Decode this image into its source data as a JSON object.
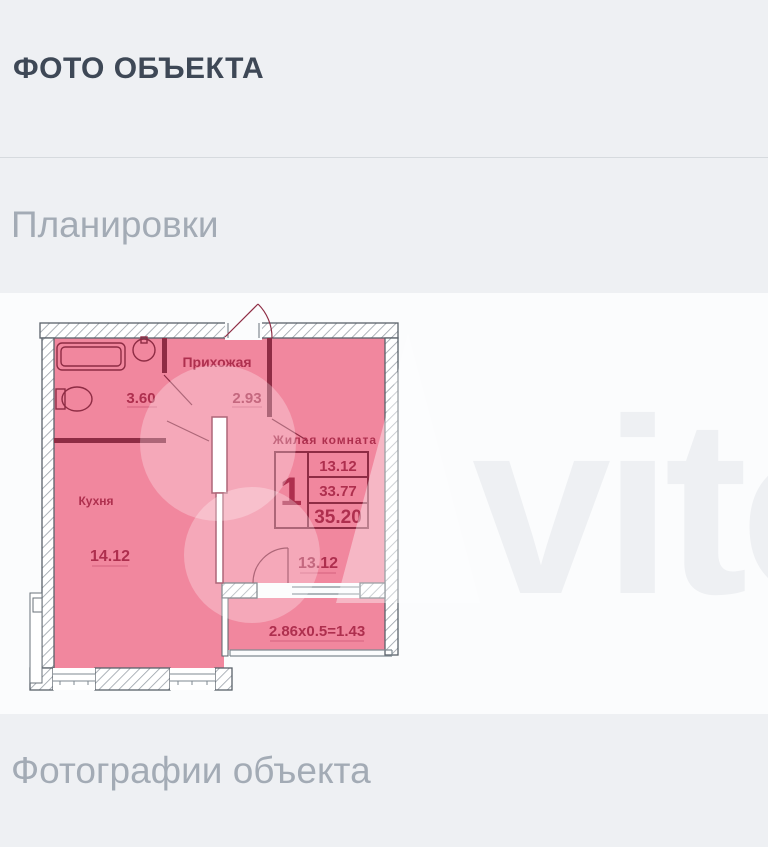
{
  "page": {
    "title": "ФОТО ОБЪЕКТА",
    "sections": {
      "floorplans": "Планировки",
      "photos": "Фотографии объекта"
    }
  },
  "floorplan": {
    "rooms": {
      "hallway": {
        "name": "Прихожая",
        "area": "2.93"
      },
      "bathroom": {
        "area": "3.60"
      },
      "kitchen": {
        "name": "Кухня",
        "area": "14.12"
      },
      "living": {
        "name": "Жилая комната",
        "area": "13.12"
      }
    },
    "balcony": {
      "formula": "2.86x0.5=1.43"
    },
    "stamp": {
      "rooms_count": "1",
      "living_area": "13.12",
      "area_wo_balcony": "33.77",
      "total_area": "35.20"
    },
    "watermark": "vito",
    "colors": {
      "room_fill": "#f1879e",
      "wall": "#8e2c44",
      "label": "#ae2f4e"
    }
  }
}
